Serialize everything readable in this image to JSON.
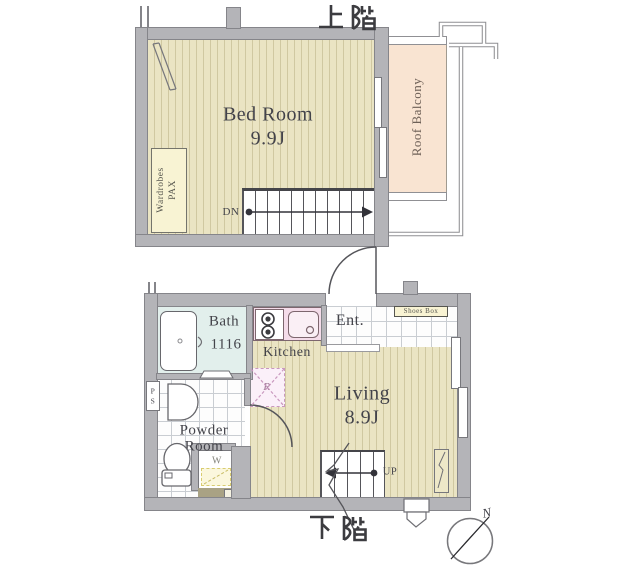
{
  "floor_plan": {
    "upper_floor": {
      "title": "上階",
      "bedroom": {
        "name": "Bed Room",
        "size": "9.9J"
      },
      "wardrobe": {
        "line1": "Wardrobes",
        "line2": "PAX"
      },
      "balcony": {
        "name": "Roof Balcony"
      },
      "stairs": {
        "direction": "DN"
      }
    },
    "lower_floor": {
      "title": "下階",
      "bath": {
        "name": "Bath",
        "size": "1116"
      },
      "kitchen": {
        "name": "Kitchen"
      },
      "entrance": {
        "name": "Ent.",
        "shoes_box": "Shoes Box"
      },
      "living": {
        "name": "Living",
        "size": "8.9J"
      },
      "powder_room": {
        "line1": "Powder",
        "line2": "Room"
      },
      "pipe_space": "PS",
      "washer": "W",
      "refrigerator": "R",
      "stairs": {
        "direction": "UP"
      }
    },
    "compass": {
      "north": "N"
    },
    "colors": {
      "wall": "#b4b4b8",
      "floor": "#eae4c3",
      "balcony": "#f9e4d2",
      "bath": "#e2efec",
      "kitchen_counter": "#f4dce9",
      "accent_yellow": "#f8f3d3"
    }
  }
}
